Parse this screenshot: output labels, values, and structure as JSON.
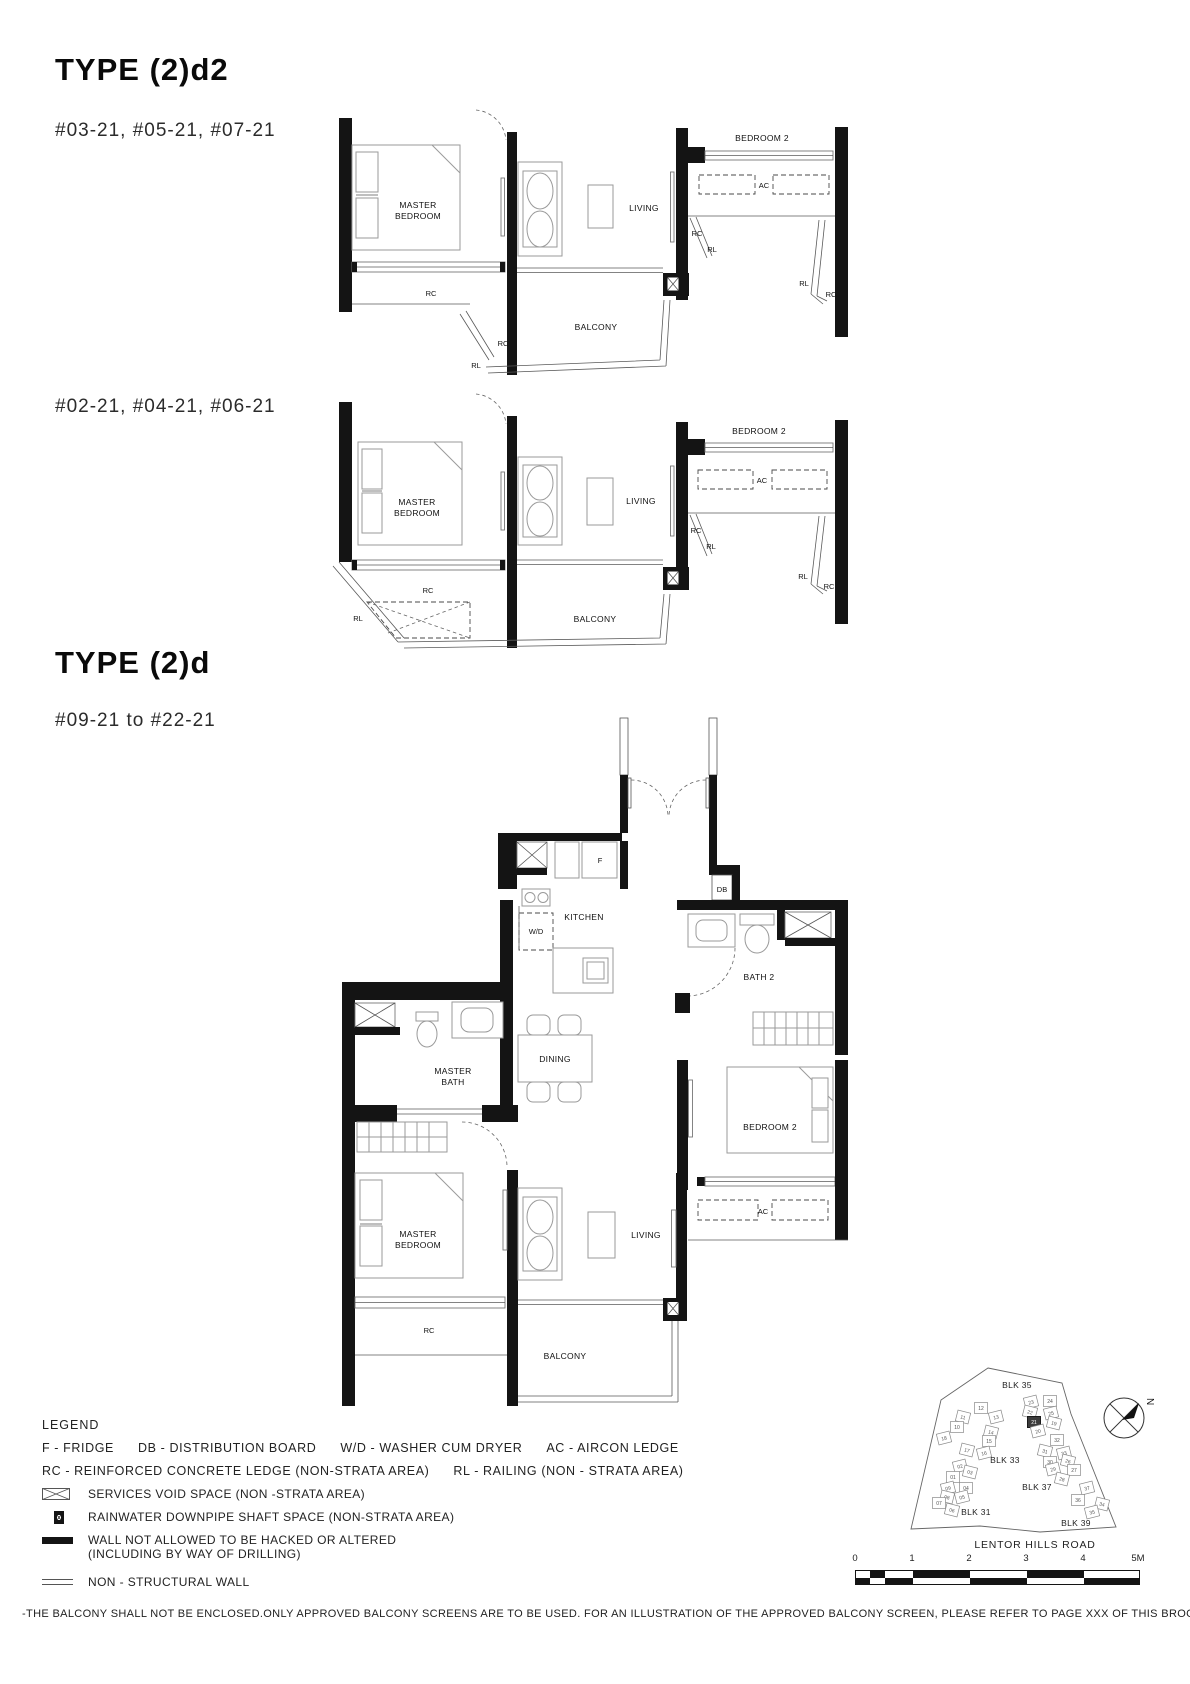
{
  "page": {
    "plans": [
      {
        "title": "TYPE (2)d2",
        "units": "#03-21, #05-21, #07-21"
      },
      {
        "units": "#02-21, #04-21, #06-21"
      },
      {
        "title": "TYPE (2)d",
        "units": "#09-21 to #22-21"
      }
    ],
    "disclaimer": "-THE BALCONY SHALL NOT BE ENCLOSED.ONLY APPROVED BALCONY SCREENS ARE TO BE USED. FOR AN ILLUSTRATION OF THE APPROVED BALCONY SCREEN, PLEASE REFER TO PAGE XXX OF THIS BROCHURE."
  },
  "labels": {
    "master": "MASTER",
    "bedroom": "BEDROOM",
    "bedroom2": "BEDROOM 2",
    "living": "LIVING",
    "balcony": "BALCONY",
    "kitchen": "KITCHEN",
    "dining": "DINING",
    "bath": "BATH",
    "bath2": "BATH 2",
    "rc": "RC",
    "rl": "RL",
    "ac": "AC",
    "f": "F",
    "wd": "W/D",
    "db": "DB"
  },
  "legend": {
    "title": "LEGEND",
    "abbr_row1": [
      "F - FRIDGE",
      "DB - DISTRIBUTION BOARD",
      "W/D - WASHER CUM DRYER",
      "AC - AIRCON LEDGE"
    ],
    "abbr_row2": [
      "RC - REINFORCED CONCRETE LEDGE (NON-STRATA AREA)",
      "RL - RAILING (NON - STRATA AREA)"
    ],
    "items": [
      {
        "symbol": "services-void",
        "label": "SERVICES VOID SPACE (NON -STRATA AREA)"
      },
      {
        "symbol": "rainwater-downpipe",
        "label": "RAINWATER DOWNPIPE SHAFT SPACE (NON-STRATA AREA)"
      },
      {
        "symbol": "hack-wall",
        "label": "WALL NOT ALLOWED TO BE HACKED OR ALTERED",
        "label2": "(INCLUDING BY WAY OF DRILLING)"
      },
      {
        "symbol": "non-structural-wall",
        "label": "NON - STRUCTURAL WALL"
      }
    ]
  },
  "siteplan": {
    "blocks": [
      {
        "label": "BLK 35"
      },
      {
        "label": "BLK 33"
      },
      {
        "label": "BLK 37"
      },
      {
        "label": "BLK 31"
      },
      {
        "label": "BLK 39"
      }
    ],
    "highlighted_unit": "21",
    "north_label": "N",
    "road": "LENTOR HILLS ROAD",
    "units": [
      {
        "n": "23",
        "x": 136,
        "y": 42
      },
      {
        "n": "24",
        "x": 155,
        "y": 41
      },
      {
        "n": "22",
        "x": 135,
        "y": 52
      },
      {
        "n": "25",
        "x": 156,
        "y": 53
      },
      {
        "n": "21",
        "x": 139,
        "y": 62,
        "hl": true
      },
      {
        "n": "19",
        "x": 159,
        "y": 63
      },
      {
        "n": "20",
        "x": 143,
        "y": 71
      },
      {
        "n": "12",
        "x": 86,
        "y": 48
      },
      {
        "n": "11",
        "x": 68,
        "y": 57
      },
      {
        "n": "13",
        "x": 101,
        "y": 57
      },
      {
        "n": "10",
        "x": 62,
        "y": 67
      },
      {
        "n": "14",
        "x": 96,
        "y": 72
      },
      {
        "n": "18",
        "x": 49,
        "y": 78
      },
      {
        "n": "15",
        "x": 94,
        "y": 81
      },
      {
        "n": "17",
        "x": 72,
        "y": 90
      },
      {
        "n": "16",
        "x": 89,
        "y": 93
      },
      {
        "n": "32",
        "x": 162,
        "y": 80
      },
      {
        "n": "31",
        "x": 150,
        "y": 91
      },
      {
        "n": "33",
        "x": 169,
        "y": 93
      },
      {
        "n": "30",
        "x": 155,
        "y": 102
      },
      {
        "n": "26",
        "x": 173,
        "y": 101
      },
      {
        "n": "29",
        "x": 158,
        "y": 109
      },
      {
        "n": "27",
        "x": 179,
        "y": 110
      },
      {
        "n": "28",
        "x": 167,
        "y": 119
      },
      {
        "n": "02",
        "x": 65,
        "y": 106
      },
      {
        "n": "01",
        "x": 58,
        "y": 117
      },
      {
        "n": "03",
        "x": 75,
        "y": 112
      },
      {
        "n": "09",
        "x": 53,
        "y": 128
      },
      {
        "n": "04",
        "x": 71,
        "y": 128
      },
      {
        "n": "08",
        "x": 52,
        "y": 137
      },
      {
        "n": "05",
        "x": 67,
        "y": 137
      },
      {
        "n": "07",
        "x": 44,
        "y": 143
      },
      {
        "n": "06",
        "x": 57,
        "y": 150
      },
      {
        "n": "37",
        "x": 192,
        "y": 128
      },
      {
        "n": "36",
        "x": 183,
        "y": 140
      },
      {
        "n": "34",
        "x": 207,
        "y": 144
      },
      {
        "n": "35",
        "x": 197,
        "y": 152
      }
    ]
  },
  "scalebar": {
    "ticks": [
      "0",
      "1",
      "2",
      "3",
      "4",
      "5M"
    ]
  }
}
